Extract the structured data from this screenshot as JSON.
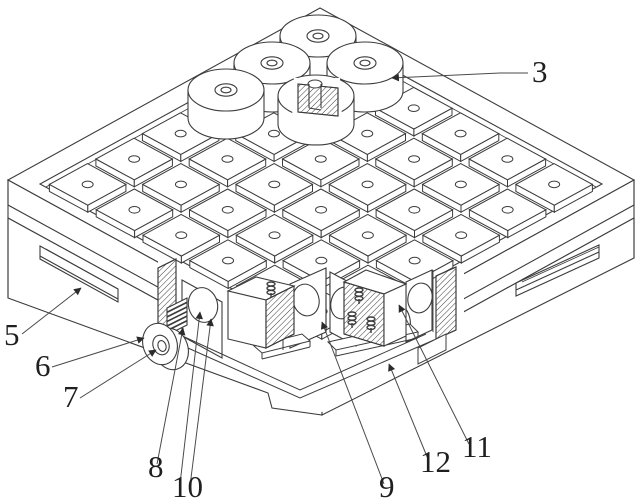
{
  "figure": {
    "kind": "patent-technical-drawing",
    "description": "Isometric view of a square clamping platform: 6x6 grid of square blocks with center bores, five cylindrical clamps near the back corner (one shown in section with a bolt), side handle slots, and a front cutaway exposing a handwheel, gear rack, bore holes and hatched sectioned slider blocks with springs.",
    "colors": {
      "background": "#ffffff",
      "line": "#3c3c3c",
      "label": "#1f1f1f",
      "hatch": "#3c3c3c"
    },
    "reference_labels": [
      {
        "text": "3",
        "x": 532,
        "y": 82,
        "leaders": [
          [
            [
              528,
              73
            ],
            [
              500,
              73
            ],
            [
              392,
              78
            ]
          ]
        ]
      },
      {
        "text": "5",
        "x": 4,
        "y": 345,
        "leaders": [
          [
            [
              22,
              334
            ],
            [
              81,
              288
            ]
          ]
        ]
      },
      {
        "text": "6",
        "x": 35,
        "y": 376,
        "leaders": [
          [
            [
              52,
              367
            ],
            [
              144,
              338
            ]
          ]
        ]
      },
      {
        "text": "7",
        "x": 63,
        "y": 407,
        "leaders": [
          [
            [
              80,
              398
            ],
            [
              156,
              350
            ]
          ]
        ]
      },
      {
        "text": "8",
        "x": 148,
        "y": 477,
        "leaders": [
          [
            [
              157,
              464
            ],
            [
              183,
              328
            ]
          ]
        ]
      },
      {
        "text": "10",
        "x": 172,
        "y": 497,
        "leaders": [
          [
            [
              180,
              484
            ],
            [
              200,
              312
            ]
          ],
          [
            [
              190,
              486
            ],
            [
              211,
              319
            ]
          ]
        ]
      },
      {
        "text": "9",
        "x": 379,
        "y": 497,
        "leaders": [
          [
            [
              384,
              484
            ],
            [
              322,
              322
            ]
          ]
        ]
      },
      {
        "text": "12",
        "x": 420,
        "y": 472,
        "leaders": [
          [
            [
              428,
              459
            ],
            [
              389,
              364
            ]
          ]
        ]
      },
      {
        "text": "11",
        "x": 462,
        "y": 457,
        "leaders": [
          [
            [
              469,
              444
            ],
            [
              399,
              305
            ]
          ]
        ]
      }
    ]
  }
}
